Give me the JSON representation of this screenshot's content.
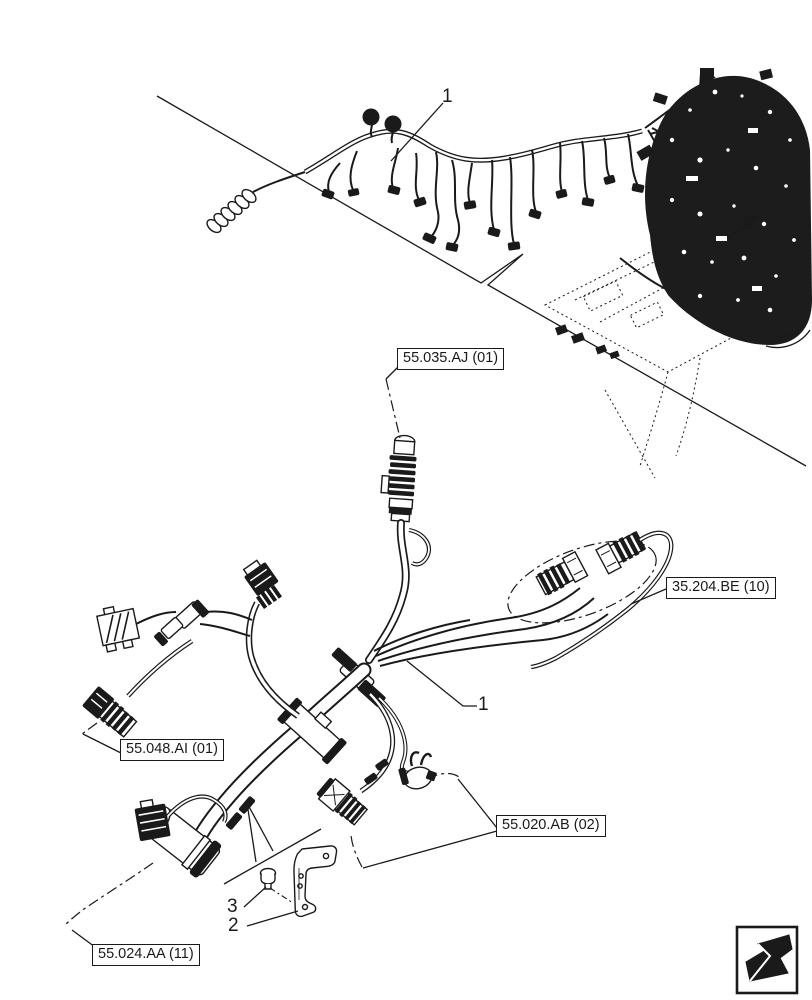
{
  "page": {
    "background": "#ffffff",
    "line_color": "#1a1a1a",
    "type": "parts-catalog-exploded-diagram",
    "subject": "engine wire harness"
  },
  "callouts": [
    {
      "id": "item-1-overview",
      "text": "1"
    },
    {
      "id": "item-1-detail",
      "text": "1"
    },
    {
      "id": "item-3-bolt",
      "text": "3"
    },
    {
      "id": "item-2-bracket",
      "text": "2"
    }
  ],
  "ref_labels": [
    {
      "id": "55-035-aj-01",
      "text": "55.035.AJ (01)"
    },
    {
      "id": "35-204-be-10",
      "text": "35.204.BE (10)"
    },
    {
      "id": "55-048-ai-01",
      "text": "55.048.AI (01)"
    },
    {
      "id": "55-020-ab-02",
      "text": "55.020.AB (02)"
    },
    {
      "id": "55-024-aa-11",
      "text": "55.024.AA (11)"
    }
  ],
  "icons": [
    {
      "id": "page-back",
      "name": "page-back-arrow-icon"
    }
  ]
}
